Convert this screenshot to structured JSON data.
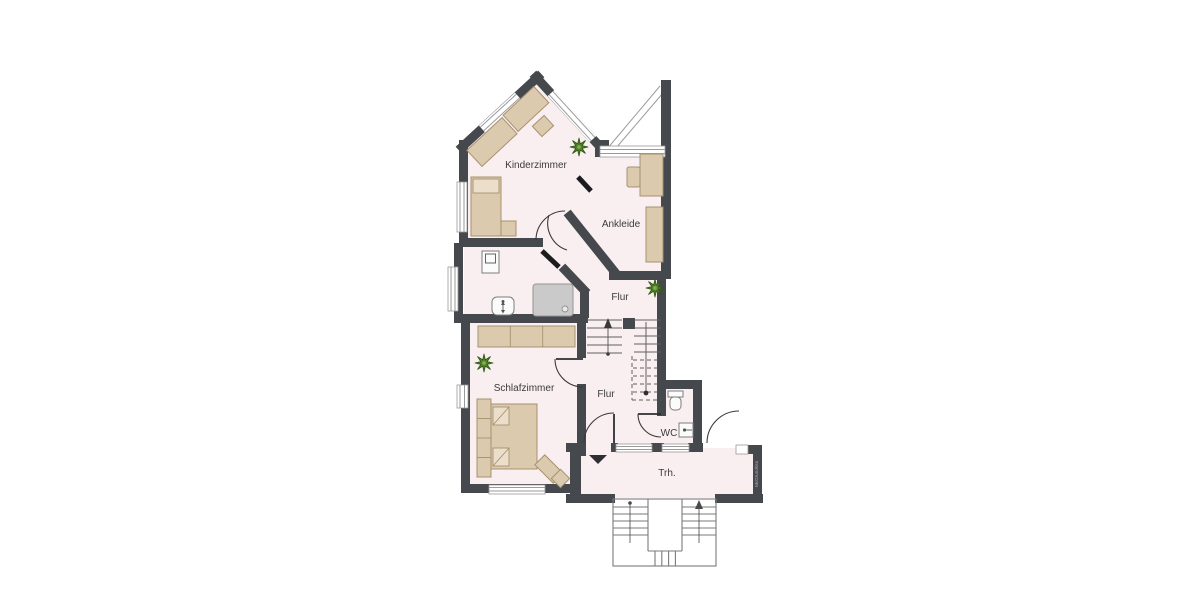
{
  "floorplan": {
    "type": "apartment-floor-plan",
    "labels": {
      "kinderzimmer": "Kinderzimmer",
      "ankleide": "Ankleide",
      "flur_upper": "Flur",
      "schlafzimmer": "Schlafzimmer",
      "flur_lower": "Flur",
      "wc": "WC",
      "treppenhaus": "Trh."
    },
    "watermark": "McGrundriss",
    "colors": {
      "wall": "#45484c",
      "floor": "#f9eff1",
      "furniture": "#dccaaf",
      "furniture_border": "#a6916e",
      "shower": "#cacaca",
      "plant": "#4f7f26",
      "label_text": "#3b3b3b"
    },
    "icons": {
      "plant": "8-point-star",
      "entrance_marker": "down-triangle",
      "stair_direction": "arrow-line-with-dot"
    }
  }
}
